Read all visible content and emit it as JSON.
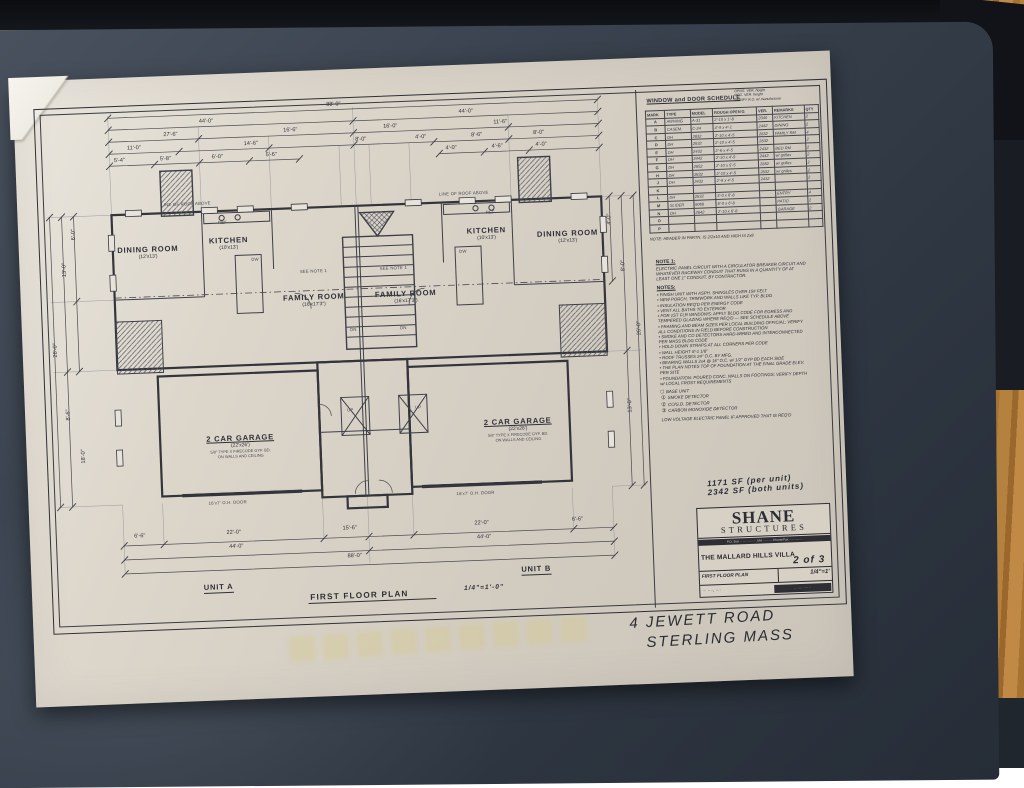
{
  "scene": {
    "desk_pad_color": "#3a434f",
    "wood_color": "#b5813f",
    "paper_color": "#d6d0c5",
    "ink_color": "#33333b"
  },
  "plan": {
    "title": "FIRST FLOOR PLAN",
    "scale": "1/4\"=1'-0\"",
    "unit_a": "UNIT A",
    "unit_b": "UNIT B",
    "rooms": [
      {
        "name": "DINING ROOM",
        "size": "(12'x13')",
        "x": 60,
        "y": 136,
        "w": 90
      },
      {
        "name": "KITCHEN",
        "size": "(10'x13')",
        "x": 150,
        "y": 130,
        "w": 72
      },
      {
        "name": "FAMILY ROOM",
        "size": "(16'x17'3\")",
        "x": 228,
        "y": 190,
        "w": 82
      },
      {
        "name": "FAMILY ROOM",
        "size": "(16'x17'3\")",
        "x": 320,
        "y": 190,
        "w": 82
      },
      {
        "name": "KITCHEN",
        "size": "(10'x13')",
        "x": 408,
        "y": 130,
        "w": 72
      },
      {
        "name": "DINING ROOM",
        "size": "(12'x13')",
        "x": 480,
        "y": 136,
        "w": 90
      }
    ],
    "garages": [
      {
        "name": "2 CAR GARAGE",
        "size": "(22'x26')",
        "n1": "5/8\" TYPE X FIRECODE GYP. BD.",
        "n2": "ON WALLS AND CEILING",
        "x": 120,
        "y": 328,
        "w": 140
      },
      {
        "name": "2 CAR GARAGE",
        "size": "(22'x26')",
        "n1": "5/8\" TYPE X FIRECODE GYP. BD.",
        "n2": "ON WALLS AND CEILING",
        "x": 398,
        "y": 322,
        "w": 140
      }
    ],
    "dims_h": [
      {
        "t": "88'-0\"",
        "x": 296,
        "y": 0
      },
      {
        "t": "44'-0\"",
        "x": 168,
        "y": 12
      },
      {
        "t": "44'-0\"",
        "x": 428,
        "y": 12
      },
      {
        "t": "27'-6\"",
        "x": 132,
        "y": 24
      },
      {
        "t": "16'-6\"",
        "x": 252,
        "y": 24
      },
      {
        "t": "16'-0\"",
        "x": 352,
        "y": 24
      },
      {
        "t": "11'-6\"",
        "x": 462,
        "y": 24
      },
      {
        "t": "11'-0\"",
        "x": 95,
        "y": 36
      },
      {
        "t": "14'-6\"",
        "x": 212,
        "y": 36
      },
      {
        "t": "8'-0\"",
        "x": 322,
        "y": 36
      },
      {
        "t": "4'-0\"",
        "x": 382,
        "y": 36
      },
      {
        "t": "8'-6\"",
        "x": 438,
        "y": 36
      },
      {
        "t": "8'-0\"",
        "x": 500,
        "y": 36
      },
      {
        "t": "5'-4\"",
        "x": 80,
        "y": 48
      },
      {
        "t": "5'-8\"",
        "x": 126,
        "y": 48
      },
      {
        "t": "6'-0\"",
        "x": 178,
        "y": 48
      },
      {
        "t": "5'-6\"",
        "x": 232,
        "y": 48
      },
      {
        "t": "4'-0\"",
        "x": 412,
        "y": 48
      },
      {
        "t": "4'-6\"",
        "x": 458,
        "y": 48
      },
      {
        "t": "4'-0\"",
        "x": 502,
        "y": 48
      },
      {
        "t": "6'-6\"",
        "x": 86,
        "y": 424
      },
      {
        "t": "22'-0\"",
        "x": 180,
        "y": 424
      },
      {
        "t": "15'-6\"",
        "x": 296,
        "y": 424
      },
      {
        "t": "22'-0\"",
        "x": 428,
        "y": 424
      },
      {
        "t": "6'-6\"",
        "x": 524,
        "y": 424
      },
      {
        "t": "44'-0\"",
        "x": 182,
        "y": 438
      },
      {
        "t": "44'-0\"",
        "x": 430,
        "y": 438
      },
      {
        "t": "88'-0\"",
        "x": 300,
        "y": 452
      }
    ],
    "dims_v": [
      {
        "t": "6'-0\"",
        "x": 26,
        "y": 120
      },
      {
        "t": "13'-0\"",
        "x": 14,
        "y": 155
      },
      {
        "t": "26'-0\"",
        "x": 2,
        "y": 235
      },
      {
        "t": "8'-6\"",
        "x": 14,
        "y": 300
      },
      {
        "t": "18'-0\"",
        "x": 26,
        "y": 342
      },
      {
        "t": "4'-0\"",
        "x": 562,
        "y": 125
      },
      {
        "t": "8'-0\"",
        "x": 574,
        "y": 172
      },
      {
        "t": "26'-0\"",
        "x": 586,
        "y": 235
      },
      {
        "t": "13'-0\"",
        "x": 574,
        "y": 312
      }
    ],
    "annos": [
      {
        "t": "LINE OF ROOF ABOVE",
        "x": 120,
        "y": 94
      },
      {
        "t": "LINE OF ROOF ABOVE",
        "x": 398,
        "y": 94
      },
      {
        "t": "REF",
        "x": 176,
        "y": 114
      },
      {
        "t": "REF",
        "x": 444,
        "y": 114
      },
      {
        "t": "DW",
        "x": 208,
        "y": 152
      },
      {
        "t": "DW",
        "x": 416,
        "y": 152
      },
      {
        "t": "SEE NOTE 1",
        "x": 256,
        "y": 166
      },
      {
        "t": "SEE NOTE 1",
        "x": 336,
        "y": 166
      },
      {
        "t": "DN",
        "x": 304,
        "y": 226
      },
      {
        "t": "DN",
        "x": 354,
        "y": 226
      },
      {
        "t": "UP",
        "x": 298,
        "y": 306
      },
      {
        "t": "UP",
        "x": 366,
        "y": 306
      },
      {
        "t": "16'x7' O.H. DOOR",
        "x": 156,
        "y": 394
      },
      {
        "t": "16'x7' O.H. DOOR",
        "x": 404,
        "y": 394
      }
    ]
  },
  "schedule": {
    "title": "WINDOW and DOOR SCHEDULE",
    "corner_note": [
      "OPNG. VER. height",
      "MFG. VER. height",
      "VERIFY R.O. w/ manufacturer"
    ],
    "headers": [
      "MARK",
      "TYPE",
      "MODEL",
      "ROUGH OPEN'G",
      "VER.",
      "REMARKS",
      "QTY"
    ],
    "rows": [
      [
        "A",
        "AWNING",
        "A-31",
        "2'-10 x 1'-8",
        "2040",
        "KITCHEN",
        "2"
      ],
      [
        "B",
        "CASEM.",
        "C-24",
        "4'-9 x 4'-1",
        "2442",
        "DINING",
        "2"
      ],
      [
        "C",
        "DH",
        "2832",
        "2'-10 x 4'-5",
        "2832",
        "FAMILY RM",
        "4"
      ],
      [
        "D",
        "DH",
        "2832",
        "2'-10 x 4'-5",
        "2832",
        "",
        "2"
      ],
      [
        "E",
        "DH",
        "2432",
        "2'-6 x 4'-5",
        "2432",
        "BED RM",
        "2"
      ],
      [
        "F",
        "DH",
        "2442",
        "2'-10 x 4'-9",
        "2442",
        "w/ grilles",
        "2"
      ],
      [
        "G",
        "DH",
        "2852",
        "2'-10 x 5'-5",
        "2852",
        "w/ grilles",
        "2"
      ],
      [
        "H",
        "DH",
        "2832",
        "2'-10 x 4'-5",
        "2832",
        "w/ grilles",
        "2"
      ],
      [
        "J",
        "DH",
        "2432",
        "2'-6 x 4'-5",
        "2432",
        "",
        "2"
      ],
      [
        "K",
        "",
        "",
        "",
        "",
        "",
        ""
      ],
      [
        "L",
        "DH",
        "2832",
        "3'-0 x 6'-8",
        "",
        "ENTRY",
        "4"
      ],
      [
        "M",
        "SLIDER",
        "6068",
        "6'-0 x 6'-8",
        "",
        "PATIO",
        "2"
      ],
      [
        "N",
        "DH",
        "2842",
        "2'-10 x 6'-8",
        "",
        "GARAGE",
        "2"
      ],
      [
        "O",
        "",
        "",
        "",
        "",
        "",
        ""
      ],
      [
        "P",
        "",
        "",
        "",
        "",
        "",
        ""
      ]
    ],
    "footnote": "NOTE: HEADER IN PARTN. IS 2/2x10 AND HIGH IS 2x8"
  },
  "notes": {
    "note1_title": "NOTE 1:",
    "note1": "ELECTRIC PANEL CIRCUIT WITH A CIRCULATOR BREAKER CIRCUIT AND WHATEVER RACEWAY CONDUIT THAT RUNS IN A QUANTITY OF AT LEAST ONE 1\" CONDUIT, BY CONTRACTOR.",
    "notes_title": "NOTES:",
    "bullets": [
      "FINISH UNIT WITH ASPH. SHINGLES OVER 15# FELT",
      "NEW PORCH, TRIMWORK AND WALLS LIKE TYP. BLDG",
      "INSULATION REQ'D PER ENERGY CODE",
      "VENT ALL BATHS TO EXTERIOR",
      "FOR 1ST FLR WINDOWS: APPLY BLDG CODE FOR EGRESS AND TEMPERED GLAZING WHERE REQ'D — SEE SCHEDULE ABOVE",
      "FRAMING AND BEAM SIZES PER LOCAL BUILDING OFFICIAL; VERIFY ALL CONDITIONS IN FIELD BEFORE CONSTRUCTION",
      "SMOKE AND CO DETECTORS HARD-WIRED AND INTERCONNECTED PER MASS BLDG CODE",
      "HOLD DOWN STRAPS AT ALL CORNERS PER CODE",
      "WALL HEIGHT 8'-1 1/8\"",
      "ROOF TRUSSES 24\" O.C. BY MFG.",
      "BEARING WALLS 2x4 @ 16\" O.C. w/ 1/2\" GYP BD EACH SIDE",
      "THE PLAN NOTES TOP OF FOUNDATION AT THE FINAL GRADE ELEV. PER SITE",
      "FOUNDATION: POURED CONC. WALLS ON FOOTINGS; VERIFY DEPTH w/ LOCAL FROST REQUIREMENTS"
    ],
    "legend": [
      {
        "sym": "□",
        "text": "BASE UNIT"
      },
      {
        "sym": "①",
        "text": "SMOKE DETECTOR"
      },
      {
        "sym": "②",
        "text": "CO/S.D. DETECTOR"
      },
      {
        "sym": "③",
        "text": "CARBON MONOXIDE DETECTOR"
      }
    ],
    "legend_note": "LOW VOLTAGE ELECTRIC PANEL IF APPROVED THAT IS REQ'D"
  },
  "titleblock": {
    "sf1": "1171 SF (per unit)",
    "sf2": "2342 SF (both units)",
    "name1": "SHANE",
    "name2": "STRUCTURES",
    "address": "P.O. Box ·· — ········, MA ····· — Phone/Fax ···-···-····",
    "project": "THE MALLARD HILLS VILLA",
    "sheet": "2 of 3",
    "drawing": "FIRST FLOOR PLAN",
    "scale": "1/4\"=1'",
    "footer_left": "··· ····, ····",
    "footer_right": "·· ···· ······"
  },
  "handwriting": {
    "line1": "4 JEWETT ROAD",
    "line2": "STERLING MASS"
  }
}
